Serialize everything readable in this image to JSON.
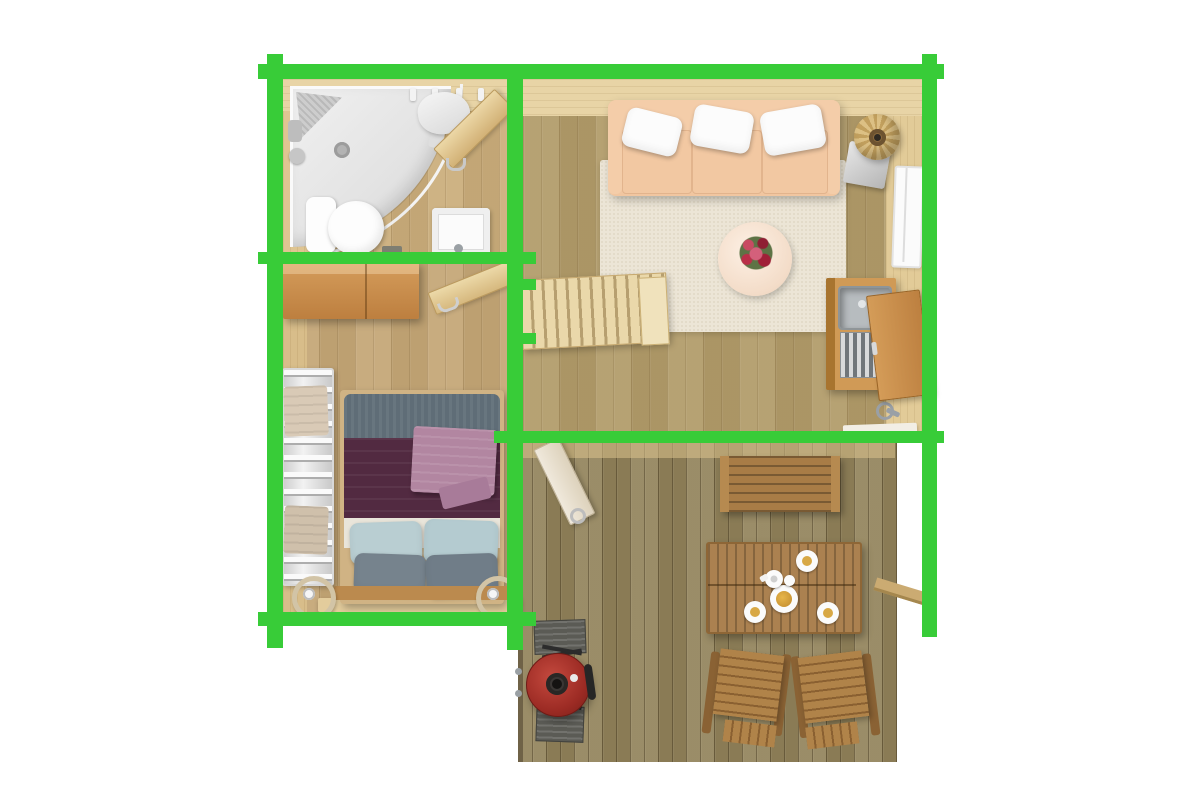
{
  "page": {
    "background": "#ffffff"
  },
  "colors": {
    "page-bg": "#ffffff",
    "wall-green": "#38cc38",
    "floor-bath": "#cbae7c",
    "floor-bedroom": "#c5a777",
    "floor-living": "#b29c6a",
    "floor-deck": "#93845c",
    "wall-band": "#e8d4a6",
    "stair-wood": "#ead8aa",
    "wardrobe-wood": "#c08544",
    "cabinet-wood": "#c68a46",
    "deck-furniture-wood": "#a87c46",
    "table-wood": "#ab8150",
    "sofa-fabric": "#f1c6a0",
    "rug-cream": "#ece5d6",
    "coffee-table-cream": "#f8e6d7",
    "flower-red": "#b92f48",
    "duvet-plum": "#522a41",
    "blanket-gray": "#5f6d77",
    "throw-mauve": "#b286a1",
    "pillow-blue": "#b9ced2",
    "pillow-gray": "#76838d",
    "grill-red": "#a8302b",
    "tray-gray": "#5b5b55",
    "porcelain-white": "#fbfbfb",
    "lamp-wicker": "#d5b67a"
  },
  "plan": {
    "view": "top-down floor plan render",
    "highlighted_walls_color": "#38cc38",
    "rooms": [
      {
        "name": "bathroom",
        "items": [
          "corner-shower",
          "shower-head",
          "corner-shelf",
          "toilet",
          "washbasin",
          "towel-hooks",
          "hanging-towel",
          "open-door"
        ]
      },
      {
        "name": "bedroom",
        "items": [
          "wardrobe",
          "open-door",
          "double-bed",
          "plum-duvet",
          "gray-blanket",
          "mauve-throw",
          "blue-pillows",
          "gray-pillows",
          "towel-radiator",
          "towels",
          "candle-lantern-left",
          "candle-lantern-right"
        ]
      },
      {
        "name": "living-room",
        "items": [
          "sofa",
          "white-cushions",
          "area-rug",
          "round-coffee-table",
          "flower-bouquet",
          "floor-lamp",
          "lamp-base-plate",
          "kitchenette-cabinet",
          "steel-sink",
          "drying-rack",
          "open-cabinet-door",
          "staircase",
          "window"
        ]
      },
      {
        "name": "deck",
        "items": [
          "open-door",
          "bench",
          "dining-table",
          "plates",
          "teapot",
          "food-plate",
          "lounge-chair-left",
          "lounge-chair-right",
          "bbq-kettle-grill",
          "grill-side-trays",
          "railing"
        ]
      }
    ]
  }
}
